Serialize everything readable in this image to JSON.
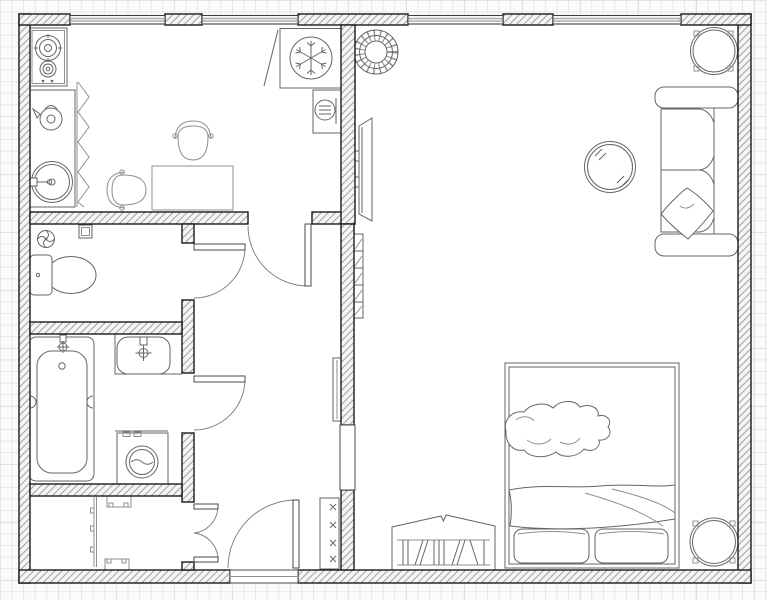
{
  "meta": {
    "title": "apartment-floor-plan",
    "canvas": {
      "width": 767,
      "height": 600
    },
    "drawing_style": "black-and-white architectural plan on graph paper, no text labels"
  },
  "colors": {
    "background": "#fbfbfc",
    "grid_minor": "#e3e5ea",
    "grid_major": "#d2d5dc",
    "wall_outline": "#1a1a1a",
    "wall_hatch": "#979797",
    "furniture_stroke": "#666666",
    "window_glass": "#a9a9a9"
  },
  "rooms": [
    {
      "name": "kitchen",
      "fixtures": [
        "gas-stove-2-burners",
        "kitchen-counter",
        "kettle",
        "round-sink",
        "accordion-rack",
        "dining-table",
        "chair",
        "chair",
        "refrigerator-snowflake",
        "boiler-cabinet",
        "open-cabinet-door"
      ]
    },
    {
      "name": "wc",
      "fixtures": [
        "extractor-fan",
        "wall-vent-box",
        "toilet-with-cistern"
      ]
    },
    {
      "name": "bathroom",
      "fixtures": [
        "bathtub-with-faucet",
        "wash-basin-with-faucet",
        "counter-edge",
        "washing-machine"
      ]
    },
    {
      "name": "closet",
      "fixtures": [
        "wardrobe-rail",
        "shelf-bracket",
        "shelf-bracket"
      ]
    },
    {
      "name": "hallway",
      "fixtures": [
        "wall-mirror",
        "coat-rack-4-hooks"
      ]
    },
    {
      "name": "living-room",
      "fixtures": [
        "wall-tv",
        "wall-radiator",
        "wicker-basket",
        "glass-coffee-table",
        "sofa-2-seats-with-pillow",
        "potted-plant-top-right",
        "potted-plant-bottom-right",
        "double-bed-2-pillows-blanket-thrown-garment",
        "bookshelf-with-books"
      ]
    }
  ],
  "openings": {
    "windows": {
      "count": 4,
      "location": "top exterior wall (2 kitchen, 2 living room)"
    },
    "doors": [
      {
        "name": "kitchen-door",
        "type": "single-swing"
      },
      {
        "name": "wc-door",
        "type": "single-swing"
      },
      {
        "name": "bathroom-door",
        "type": "single-swing"
      },
      {
        "name": "closet-doors",
        "type": "double-swing"
      },
      {
        "name": "entrance-door",
        "type": "single-swing-bottom-wall"
      },
      {
        "name": "living-room-passage",
        "type": "open-passage-no-door"
      }
    ]
  }
}
